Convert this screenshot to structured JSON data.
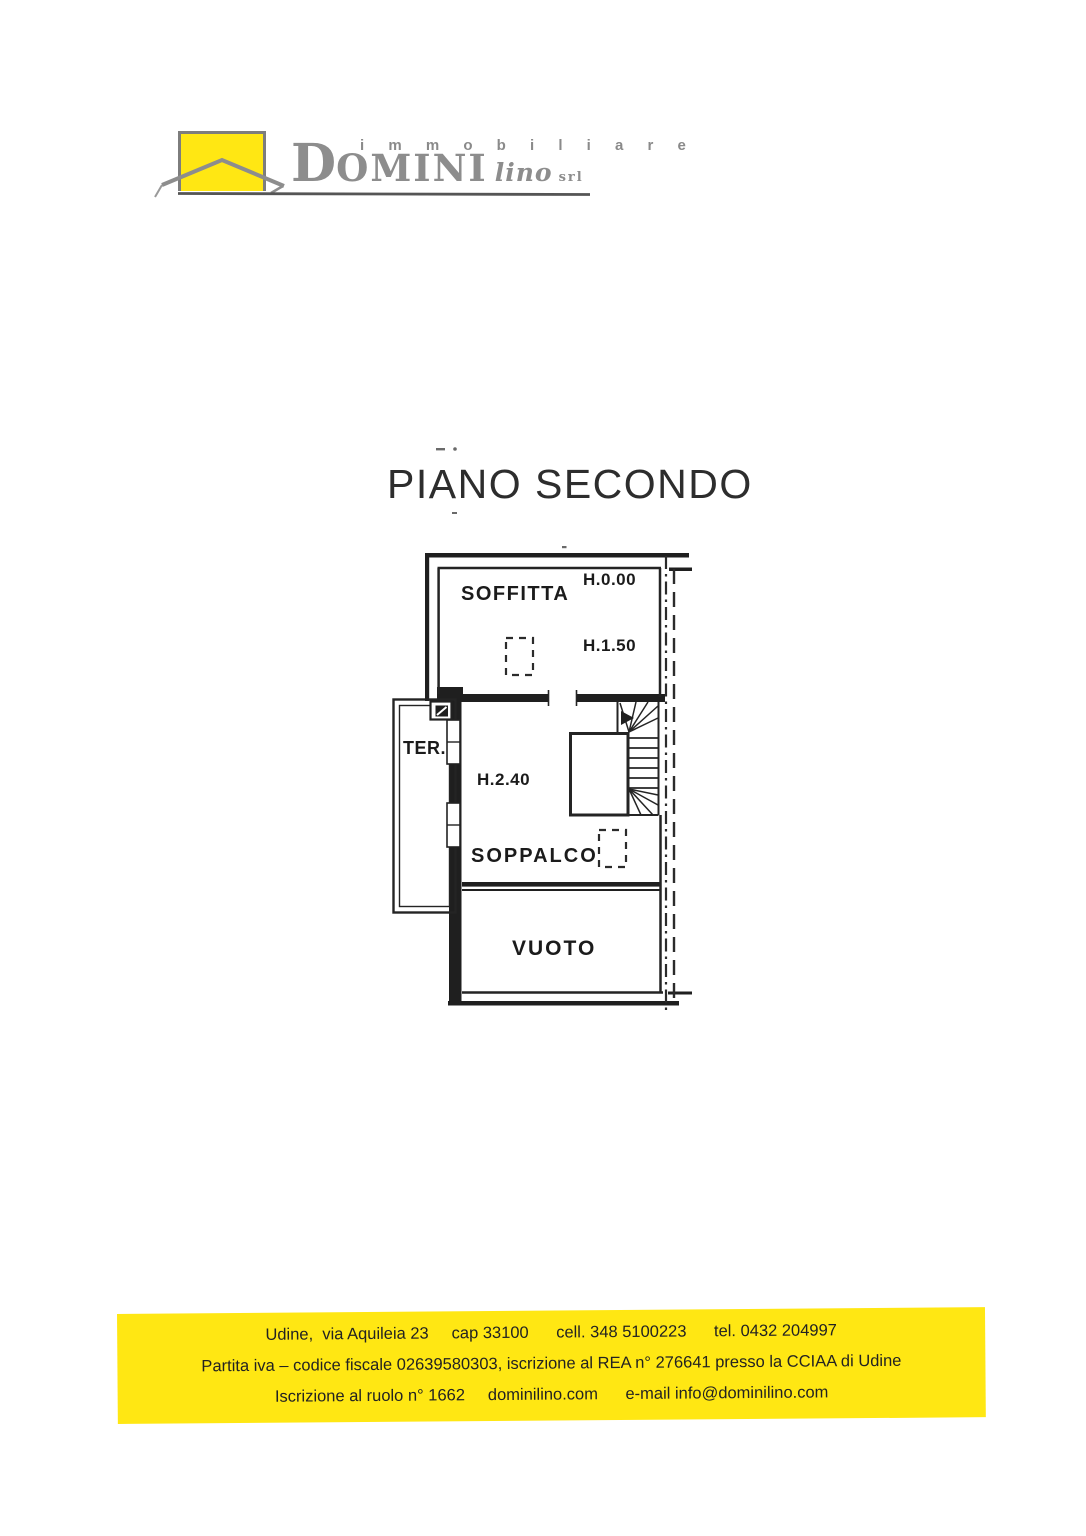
{
  "logo": {
    "tagline": "i m m o b i l i a r e",
    "brand_initial": "D",
    "brand_rest": "OMINI",
    "brand_name": "lino",
    "brand_suffix": "srl",
    "accent_yellow": "#ffe713"
  },
  "title": "PIANO SECONDO",
  "plan": {
    "rooms": {
      "soffitta": "SOFFITTA",
      "terrace": "TER.",
      "soppalco": "SOPPALCO",
      "vuoto": "VUOTO"
    },
    "heights": {
      "h_zero": "H.0.00",
      "h_one_fifty": "H.1.50",
      "h_two_forty": "H.2.40"
    }
  },
  "footer": {
    "background": "#ffe713",
    "line1": "Udine,  via Aquileia 23     cap 33100      cell. 348 5100223      tel. 0432 204997",
    "line2": "Partita iva – codice fiscale 02639580303, iscrizione al REA n° 276641 presso la CCIAA di Udine",
    "line3": "Iscrizione al ruolo n° 1662     dominilino.com      e-mail info@dominilino.com"
  }
}
